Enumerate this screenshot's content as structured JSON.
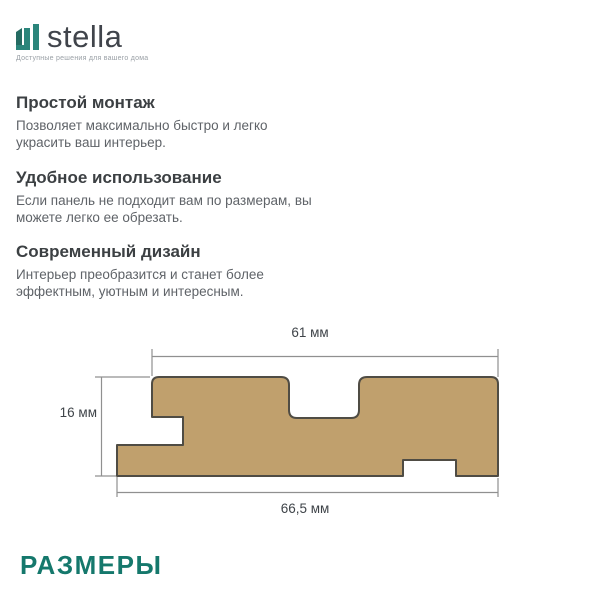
{
  "brand": {
    "name": "stella",
    "tagline": "Доступные решения для вашего дома",
    "logo_color_dark": "#256b62",
    "logo_color": "#2b857b"
  },
  "features": [
    {
      "title": "Простой монтаж",
      "description": "Позволяет максимально быстро и легко украсить ваш интерьер."
    },
    {
      "title": "Удобное использование",
      "description": "Если панель не подходит вам по размерам, вы можете легко ее обрезать."
    },
    {
      "title": "Современный дизайн",
      "description": "Интерьер преобразится и станет более эффектным, уютным и интересным."
    }
  ],
  "diagram": {
    "type": "panel-cross-section",
    "width_top_label": "61 мм",
    "height_label": "16 мм",
    "width_bottom_label": "66,5 мм",
    "panel_fill": "#c0a06d",
    "panel_stroke": "#4f4c44",
    "dim_line_color": "#909090"
  },
  "section_title": "РАЗМЕРЫ",
  "accent_color": "#15786c"
}
